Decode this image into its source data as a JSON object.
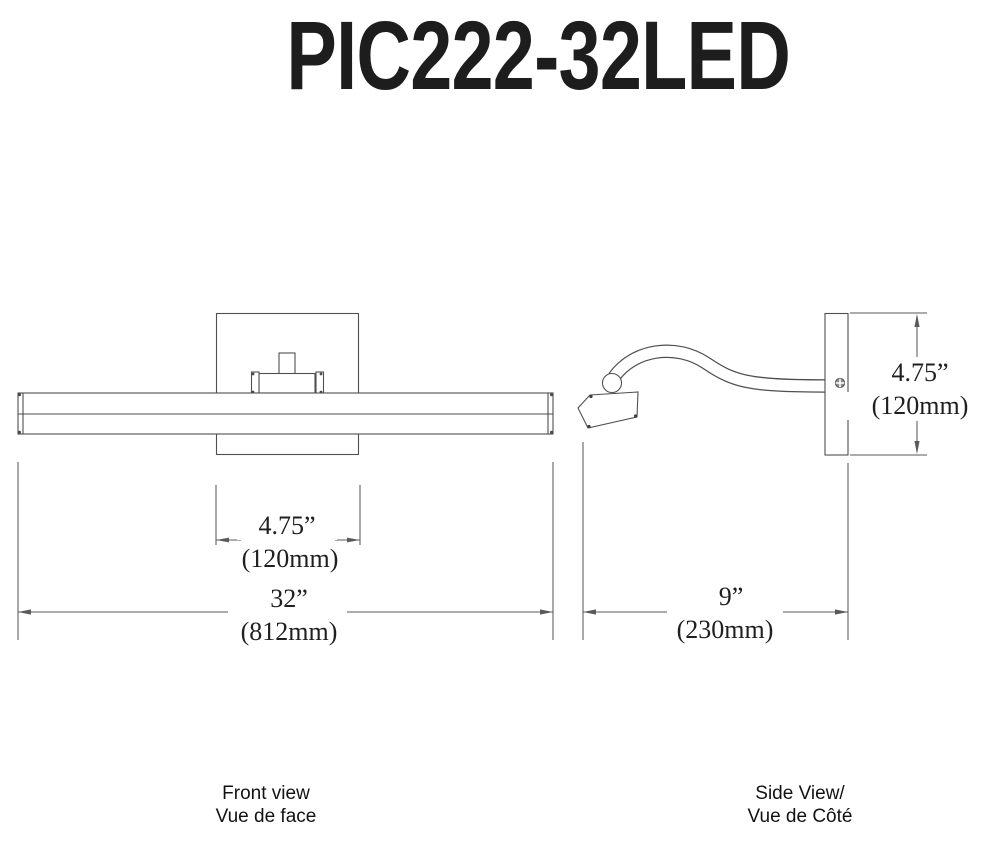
{
  "title": "PIC222-32LED",
  "views": {
    "front": {
      "label_line1": "Front view",
      "label_line2": "Vue de face"
    },
    "side": {
      "label_line1": "Side View/",
      "label_line2": "Vue de Côté"
    }
  },
  "dimensions": {
    "fixture_width": {
      "inches": "32”",
      "metric": "(812mm)"
    },
    "backplate_width": {
      "inches": "4.75”",
      "metric": "(120mm)"
    },
    "extension_depth": {
      "inches": "9”",
      "metric": "(230mm)"
    },
    "backplate_height": {
      "inches": "4.75”",
      "metric": "(120mm)"
    }
  },
  "colors": {
    "line": "#4f4f4f",
    "dimension_line": "#5a5a5a",
    "text": "#1f1f1f",
    "background": "#ffffff"
  }
}
